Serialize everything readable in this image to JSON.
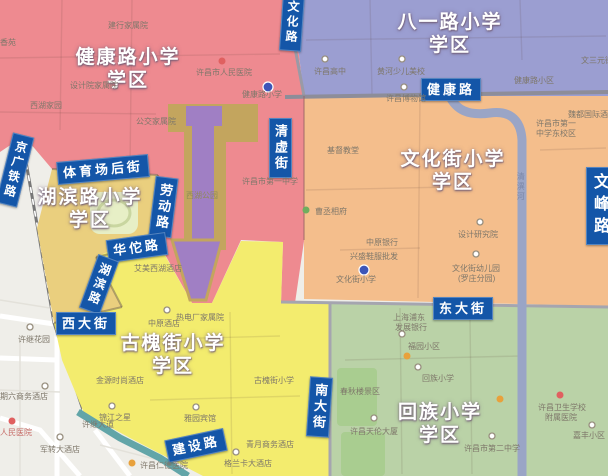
{
  "colors": {
    "outside": "#EFEEE9",
    "district_red": "#EE8A90",
    "district_purple": "#9B9ED1",
    "district_orange": "#F4BE8C",
    "district_tan": "#EACF7E",
    "district_yellow": "#F3EC6E",
    "district_green": "#BAD2A7",
    "park_olive": "#C3A55E",
    "lake_purple": "#A07FC4",
    "river": "#9AA5C6",
    "road_major": "#8D8D99",
    "road_minor": "#ABA8B0",
    "road_teal": "#62A5A8",
    "label_bg": "#1456A8",
    "school_dot": "#3D55B8"
  },
  "districts": [
    {
      "name": "健康路小学学区",
      "line1": "健康路小学",
      "line2": "学区",
      "color": "#EE8A90"
    },
    {
      "name": "八一路小学学区",
      "line1": "八一路小学",
      "line2": "学区",
      "color": "#9B9ED1"
    },
    {
      "name": "文化街小学学区",
      "line1": "文化街小学",
      "line2": "学区",
      "color": "#F4BE8C"
    },
    {
      "name": "湖滨路小学学区",
      "line1": "湖滨路小学",
      "line2": "学区",
      "color": "#EACF7E"
    },
    {
      "name": "古槐街小学学区",
      "line1": "古槐街小学",
      "line2": "学区",
      "color": "#F3EC6E"
    },
    {
      "name": "回族小学学区",
      "line1": "回族小学",
      "line2": "学区",
      "color": "#BAD2A7"
    }
  ],
  "road_labels": [
    "文化路",
    "健康路",
    "清虚街",
    "文峰路",
    "京广铁路",
    "体育场后街",
    "劳动路",
    "华佗路",
    "湖滨路",
    "西大街",
    "东大街",
    "南大街",
    "建设路"
  ],
  "water": {
    "river": "清潩河"
  },
  "park": {
    "name": "西湖公园"
  },
  "pois": [
    "建行家属院",
    "许昌市人民医院",
    "健康路小学",
    "设计院家属院",
    "西湖家园",
    "公交家属院",
    "许昌市第一中学",
    "丁香苑",
    "许昌高中",
    "黄河少儿美校",
    "健康路小区",
    "文三元街",
    "许昌博物馆",
    "许昌市第一",
    "中学东校区",
    "魏都国际酒店",
    "基督教堂",
    "曹丞相府",
    "设计研究院",
    "中原银行",
    "兴盛鞋服批发",
    "文化街小学",
    "文化街幼儿园",
    "(罗庄分园)",
    "中原酒店",
    "热电厂家属院",
    "艾美西湖酒店",
    "古槐街小学",
    "金源时尚酒店",
    "锦江之星",
    "雅园宾馆",
    "青月商务酒店",
    "格兰卡大酒店",
    "上海浦东",
    "发展银行",
    "福园小区",
    "回族小学",
    "春秋楼景区",
    "许昌天伦大厦",
    "许昌市第二中学",
    "许昌卫生学校",
    "附属医院",
    "嘉丰小区",
    "许继花园",
    "期六商务酒店",
    "人民医院",
    "军转大酒店",
    "许昌仁德医院",
    "许继大道"
  ]
}
